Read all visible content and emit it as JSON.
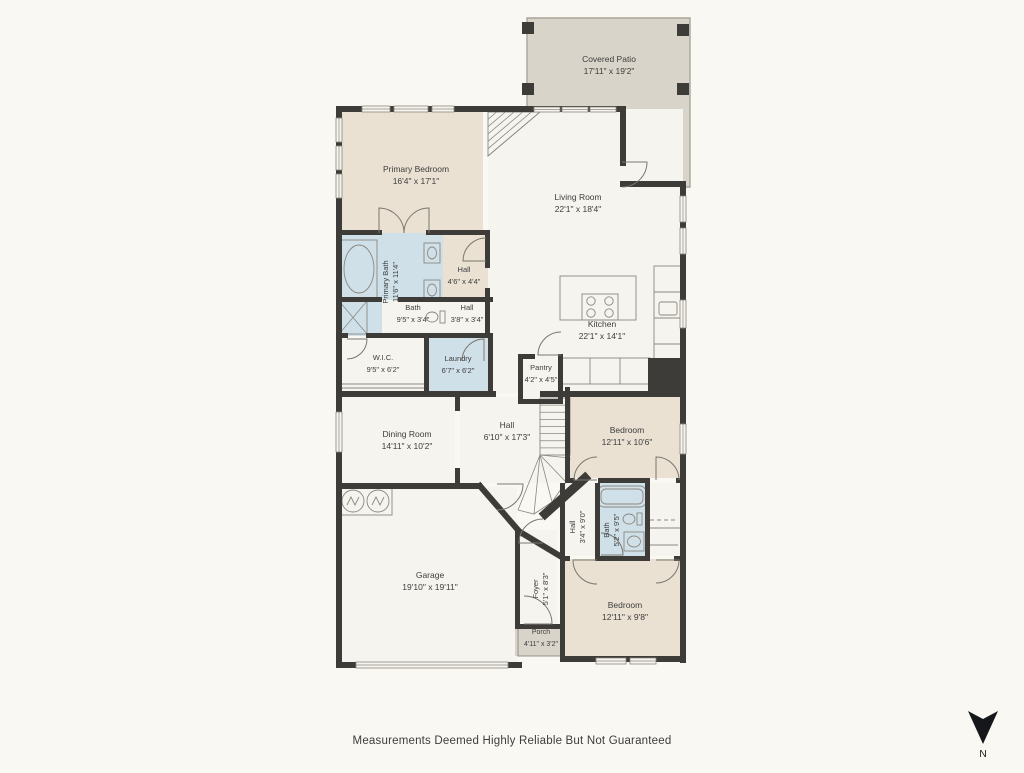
{
  "footer": {
    "disclaimer": "Measurements Deemed Highly Reliable But Not Guaranteed"
  },
  "compass": {
    "label": "N"
  },
  "colors": {
    "bg": "#faf8f3",
    "wall": "#3e3c38",
    "tan": "#eae1d3",
    "blue": "#cfe0e9",
    "white": "#f6f4ee",
    "patio": "#d9d4c9",
    "patio_edge": "#a9a59a",
    "line": "#8c8880",
    "door": "#7a776e",
    "text": "#3d3d3d",
    "window_fill": "#f7f5ef"
  },
  "plan": {
    "patio": {
      "path": "M527,18 H690 V187 H623 V112 H527 Z"
    },
    "posts": [
      [
        522,
        22
      ],
      [
        677,
        24
      ],
      [
        522,
        83
      ],
      [
        677,
        83
      ]
    ],
    "hatch": {
      "pts": [
        [
          488,
          112
        ],
        [
          540,
          112
        ],
        [
          488,
          156
        ]
      ],
      "n": 6
    },
    "rooms": [
      {
        "id": "covered-patio",
        "label": "Covered Patio",
        "dim": "17'11\" x 19'2\"",
        "lx": 609,
        "ly": 62,
        "fs": 8.5
      },
      {
        "id": "primary-bedroom",
        "rect": [
          339,
          109,
          144,
          124
        ],
        "fill": "tan",
        "label": "Primary Bedroom",
        "dim": "16'4\" x 17'1\"",
        "lx": 416,
        "ly": 172,
        "fs": 8.5
      },
      {
        "id": "hall-upper-closet",
        "rect": [
          443,
          233,
          45,
          102
        ],
        "fill": "tan"
      },
      {
        "id": "primary-bath",
        "rect": [
          339,
          233,
          104,
          103
        ],
        "fill": "blue",
        "label": "Primary Bath",
        "dim": "11'6\" x 11'4\"",
        "lx": 388,
        "ly": 282,
        "rot": true,
        "fs": 7.5
      },
      {
        "id": "bath-hall-row",
        "rect": [
          382,
          300,
          108,
          35
        ],
        "fill": "white"
      },
      {
        "id": "living-kitchen",
        "rect": [
          488,
          109,
          195,
          284
        ],
        "fill": "white",
        "label": "Living Room",
        "dim": "22'1\" x 18'4\"",
        "lx": 578,
        "ly": 200,
        "fs": 8.5
      },
      {
        "id": "kitchen",
        "label": "Kitchen",
        "dim": "22'1\" x 14'1\"",
        "lx": 602,
        "ly": 327,
        "fs": 8.5
      },
      {
        "id": "hall-upper",
        "label": "Hall",
        "dim": "4'6\" x 4'4\"",
        "lx": 464,
        "ly": 272,
        "fs": 7.5
      },
      {
        "id": "bath-small",
        "label": "Bath",
        "dim": "9'5\" x 3'4\"",
        "lx": 413,
        "ly": 310,
        "fs": 7.5
      },
      {
        "id": "hall-small",
        "label": "Hall",
        "dim": "3'8\" x 3'4\"",
        "lx": 467,
        "ly": 310,
        "fs": 7.5
      },
      {
        "id": "wic",
        "rect": [
          341,
          338,
          83,
          53
        ],
        "fill": "white",
        "label": "W.I.C.",
        "dim": "9'5\" x 6'2\"",
        "lx": 383,
        "ly": 360,
        "fs": 7.5
      },
      {
        "id": "laundry",
        "rect": [
          429,
          338,
          59,
          53
        ],
        "fill": "blue",
        "label": "Laundry",
        "dim": "6'7\" x 6'2\"",
        "lx": 458,
        "ly": 361,
        "fs": 7.5
      },
      {
        "id": "pantry",
        "rect": [
          521,
          357,
          39,
          41
        ],
        "fill": "white",
        "label": "Pantry",
        "dim": "4'2\" x 4'5\"",
        "lx": 541,
        "ly": 370,
        "fs": 7.5
      },
      {
        "id": "dining-room",
        "rect": [
          341,
          397,
          114,
          86
        ],
        "fill": "white",
        "label": "Dining Room",
        "dim": "14'11\" x 10'2\"",
        "lx": 407,
        "ly": 437,
        "fs": 8.5
      },
      {
        "id": "hall-main",
        "rect": [
          460,
          397,
          105,
          86
        ],
        "fill": "white",
        "label": "Hall",
        "dim": "6'10\" x 17'3\"",
        "lx": 507,
        "ly": 428,
        "fs": 8.5
      },
      {
        "id": "bedroom-mid",
        "rect": [
          570,
          391,
          110,
          87
        ],
        "fill": "tan",
        "label": "Bedroom",
        "dim": "12'11\" x 10'6\"",
        "lx": 627,
        "ly": 433,
        "fs": 8.5
      },
      {
        "id": "hall-vert",
        "rect": [
          565,
          483,
          30,
          73
        ],
        "fill": "white",
        "label": "Hall",
        "dim": "3'4\" x 9'0\"",
        "lx": 575,
        "ly": 527,
        "rot": true,
        "fs": 7.5
      },
      {
        "id": "bath-bottom",
        "rect": [
          600,
          483,
          45,
          73
        ],
        "fill": "blue",
        "label": "Bath",
        "dim": "5'2\" x 9'5\"",
        "lx": 609,
        "ly": 530,
        "rot": true,
        "fs": 7.5
      },
      {
        "id": "closet-mid",
        "rect": [
          650,
          483,
          30,
          73
        ],
        "fill": "white"
      },
      {
        "id": "garage",
        "rect": [
          341,
          487,
          176,
          177
        ],
        "fill": "white",
        "label": "Garage",
        "dim": "19'10\" x 19'11\"",
        "lx": 430,
        "ly": 578,
        "fs": 8.5
      },
      {
        "id": "foyer",
        "rect": [
          518,
          530,
          39,
          96
        ],
        "fill": "white",
        "label": "Foyer",
        "dim": "5'1\" x 8'3\"",
        "lx": 538,
        "ly": 589,
        "rot": true,
        "fs": 7.5
      },
      {
        "id": "porch",
        "rect": [
          515,
          626,
          48,
          30
        ],
        "fill": "patio",
        "label": "Porch",
        "dim": "4'11\" x 3'2\"",
        "lx": 541,
        "ly": 634,
        "fs": 7
      },
      {
        "id": "bedroom-bottom",
        "rect": [
          565,
          559,
          117,
          99
        ],
        "fill": "tan",
        "label": "Bedroom",
        "dim": "12'11\" x 9'8\"",
        "lx": 625,
        "ly": 608,
        "fs": 8.5
      }
    ],
    "walls": [
      [
        336,
        106,
        290,
        6
      ],
      [
        620,
        106,
        6,
        60
      ],
      [
        620,
        181,
        66,
        6
      ],
      [
        680,
        181,
        6,
        482
      ],
      [
        336,
        106,
        6,
        562
      ],
      [
        336,
        662,
        186,
        6
      ],
      [
        560,
        656,
        126,
        6
      ],
      [
        336,
        230,
        46,
        5
      ],
      [
        426,
        230,
        64,
        5
      ],
      [
        485,
        230,
        5,
        38
      ],
      [
        485,
        288,
        5,
        50
      ],
      [
        336,
        297,
        46,
        5
      ],
      [
        398,
        297,
        95,
        5
      ],
      [
        336,
        333,
        12,
        5
      ],
      [
        366,
        333,
        127,
        5
      ],
      [
        424,
        338,
        5,
        57
      ],
      [
        488,
        338,
        5,
        57
      ],
      [
        336,
        391,
        160,
        6
      ],
      [
        455,
        397,
        5,
        14
      ],
      [
        455,
        468,
        5,
        16
      ],
      [
        518,
        354,
        5,
        50
      ],
      [
        558,
        354,
        5,
        50
      ],
      [
        523,
        354,
        12,
        5
      ],
      [
        518,
        399,
        45,
        5
      ],
      [
        540,
        391,
        146,
        6
      ],
      [
        648,
        358,
        38,
        36
      ],
      [
        565,
        387,
        5,
        96
      ],
      [
        565,
        478,
        10,
        5
      ],
      [
        598,
        478,
        52,
        5
      ],
      [
        676,
        478,
        10,
        5
      ],
      [
        560,
        483,
        5,
        78
      ],
      [
        595,
        483,
        5,
        78
      ],
      [
        645,
        483,
        5,
        78
      ],
      [
        560,
        556,
        10,
        5
      ],
      [
        597,
        556,
        50,
        5
      ],
      [
        674,
        556,
        12,
        5
      ],
      [
        560,
        556,
        5,
        105
      ],
      [
        336,
        483,
        146,
        6
      ],
      [
        515,
        530,
        5,
        96
      ],
      [
        515,
        624,
        48,
        5
      ]
    ],
    "diagonals": [
      [
        480,
        486,
        518,
        530,
        6
      ],
      [
        545,
        514,
        585,
        478,
        9
      ],
      [
        520,
        532,
        560,
        556,
        6
      ]
    ],
    "windows": [
      [
        362,
        106,
        28,
        6
      ],
      [
        394,
        106,
        34,
        6
      ],
      [
        432,
        106,
        22,
        6
      ],
      [
        534,
        107,
        26,
        5
      ],
      [
        562,
        107,
        26,
        5
      ],
      [
        590,
        107,
        26,
        5
      ],
      [
        336,
        118,
        6,
        24
      ],
      [
        336,
        146,
        6,
        24
      ],
      [
        336,
        174,
        6,
        24
      ],
      [
        336,
        412,
        6,
        40
      ],
      [
        680,
        196,
        6,
        26
      ],
      [
        680,
        228,
        6,
        26
      ],
      [
        680,
        300,
        6,
        28
      ],
      [
        680,
        424,
        6,
        30
      ],
      [
        596,
        658,
        30,
        6
      ],
      [
        630,
        658,
        26,
        6
      ],
      [
        356,
        662,
        152,
        6
      ]
    ],
    "doors": [
      [
        379,
        233,
        25,
        -90,
        0
      ],
      [
        429,
        233,
        25,
        -90,
        -180
      ],
      [
        622,
        162,
        25,
        0,
        90
      ],
      [
        486,
        261,
        23,
        180,
        270
      ],
      [
        484,
        361,
        22,
        270,
        180
      ],
      [
        347,
        339,
        20,
        0,
        90
      ],
      [
        561,
        355,
        23,
        180,
        270
      ],
      [
        597,
        480,
        23,
        180,
        270
      ],
      [
        656,
        480,
        23,
        270,
        360
      ],
      [
        601,
        555,
        22,
        0,
        270
      ],
      [
        597,
        560,
        24,
        180,
        90
      ],
      [
        656,
        560,
        23,
        0,
        90
      ],
      [
        524,
        624,
        28,
        0,
        270
      ],
      [
        497,
        484,
        26,
        0,
        90
      ],
      [
        543,
        543,
        24,
        180,
        270
      ]
    ],
    "fixtures": [
      {
        "t": "tub",
        "r": [
          341,
          240,
          36,
          58
        ]
      },
      {
        "t": "xbox",
        "r": [
          339,
          301,
          28,
          33
        ]
      },
      {
        "t": "sink",
        "r": [
          424,
          243,
          16,
          20
        ]
      },
      {
        "t": "sink",
        "r": [
          424,
          280,
          16,
          20
        ]
      },
      {
        "t": "toilet",
        "e": [
          432,
          317,
          6,
          5
        ],
        "tank": [
          440,
          311,
          5,
          12
        ]
      },
      {
        "t": "rect",
        "r": [
          560,
          276,
          76,
          44
        ],
        "f": "white"
      },
      {
        "t": "burners",
        "r": [
          582,
          294,
          36,
          26
        ]
      },
      {
        "t": "rect",
        "r": [
          654,
          266,
          27,
          100
        ]
      },
      {
        "t": "ln",
        "l": [
          654,
          292,
          681,
          292
        ]
      },
      {
        "t": "ln",
        "l": [
          654,
          318,
          681,
          318
        ]
      },
      {
        "t": "ln",
        "l": [
          654,
          344,
          681,
          344
        ]
      },
      {
        "t": "rect2",
        "r": [
          659,
          302,
          18,
          13
        ]
      },
      {
        "t": "rect",
        "r": [
          560,
          358,
          90,
          26
        ]
      },
      {
        "t": "ln",
        "l": [
          590,
          358,
          590,
          384
        ]
      },
      {
        "t": "ln",
        "l": [
          620,
          358,
          620,
          384
        ]
      },
      {
        "t": "rect",
        "r": [
          340,
          488,
          52,
          27
        ]
      },
      {
        "t": "zz",
        "c": [
          353,
          501,
          11
        ]
      },
      {
        "t": "zz",
        "c": [
          378,
          501,
          11
        ]
      },
      {
        "t": "btub",
        "r": [
          598,
          486,
          48,
          21
        ]
      },
      {
        "t": "toilet",
        "e": [
          629,
          519,
          6,
          5
        ],
        "tank": [
          637,
          513,
          5,
          12
        ]
      },
      {
        "t": "sink",
        "r": [
          624,
          532,
          20,
          19
        ]
      },
      {
        "t": "dash",
        "l": [
          650,
          520,
          678,
          520
        ]
      },
      {
        "t": "ln",
        "l": [
          650,
          545,
          678,
          545
        ]
      },
      {
        "t": "ln",
        "l": [
          645,
          528,
          686,
          528
        ]
      },
      {
        "t": "ln",
        "l": [
          341,
          384,
          424,
          384
        ]
      },
      {
        "t": "ln",
        "l": [
          341,
          388,
          424,
          388
        ]
      },
      {
        "t": "treads",
        "r": [
          540,
          398,
          30,
          57
        ],
        "n": 8
      },
      {
        "t": "fan",
        "c": [
          540,
          455
        ],
        "pts": [
          [
            570,
            458
          ],
          [
            566,
            482
          ],
          [
            552,
            502
          ],
          [
            534,
            514
          ],
          [
            518,
            510
          ]
        ]
      },
      {
        "t": "rect",
        "r": [
          518,
          628,
          45,
          28
        ]
      }
    ],
    "compass": {
      "dart": "M968,711 L983,744 L998,711 L983,719 Z",
      "nx": 983,
      "ny": 757
    }
  }
}
